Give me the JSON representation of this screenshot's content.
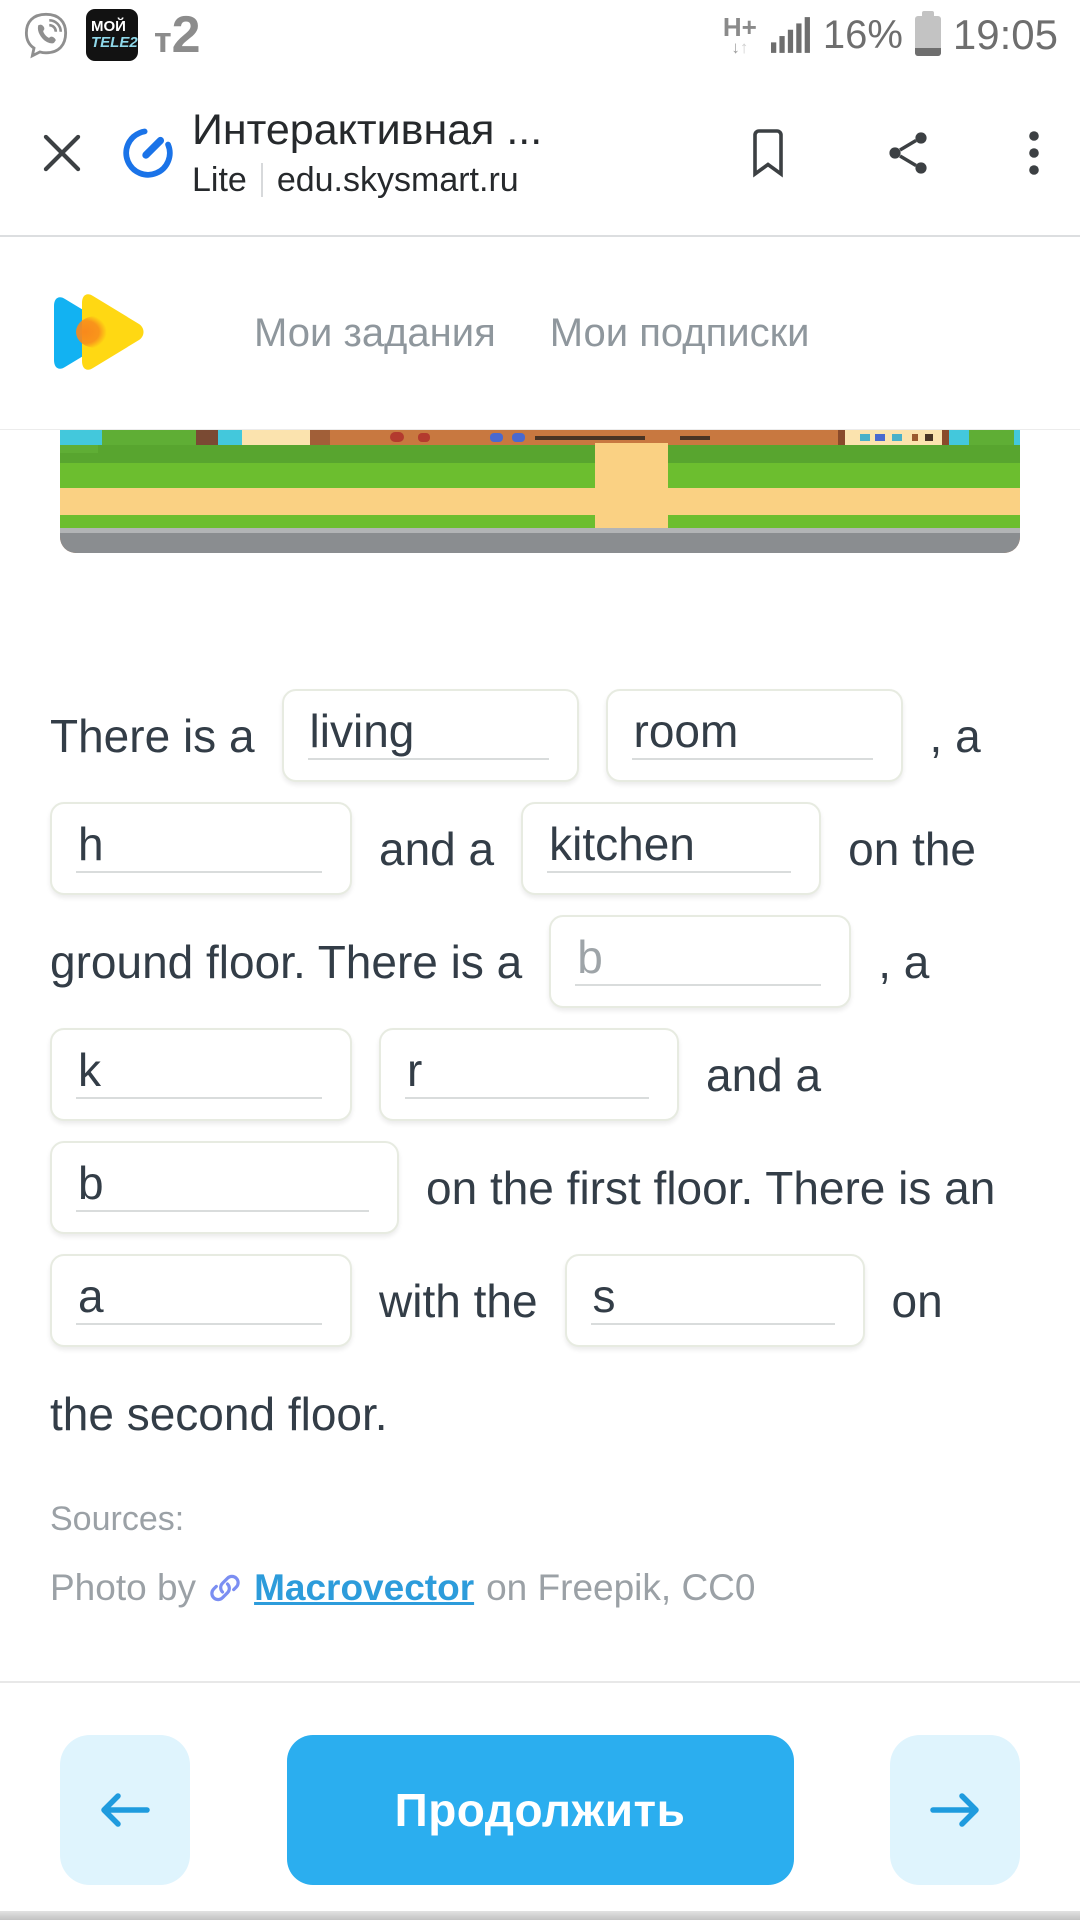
{
  "status_bar": {
    "time": "19:05",
    "battery_percent": "16%",
    "network_type": "H+",
    "carrier_badge_line1": "МОЙ",
    "carrier_badge_line2": "TELE2",
    "carrier_logo_t": "т",
    "carrier_logo_2": "2"
  },
  "browser": {
    "page_title": "Интерактивная ...",
    "mode_label": "Lite",
    "url": "edu.skysmart.ru"
  },
  "nav": {
    "links": [
      {
        "label": "Мои задания"
      },
      {
        "label": "Мои подписки"
      }
    ]
  },
  "exercise": {
    "rows": [
      {
        "segments": [
          {
            "type": "text",
            "text": "There is a"
          },
          {
            "type": "input",
            "value": "living",
            "state": "filled",
            "width": 297
          },
          {
            "type": "input",
            "value": "room",
            "state": "filled",
            "width": 297
          },
          {
            "type": "text",
            "text": ", a"
          }
        ]
      },
      {
        "segments": [
          {
            "type": "input",
            "value": "h",
            "state": "filled",
            "width": 302
          },
          {
            "type": "text",
            "text": "and a"
          },
          {
            "type": "input",
            "value": "kitchen",
            "state": "filled",
            "width": 300
          },
          {
            "type": "text",
            "text": "on the"
          }
        ]
      },
      {
        "segments": [
          {
            "type": "text",
            "text": "ground floor. There is a"
          },
          {
            "type": "input",
            "value": "b",
            "state": "hint",
            "width": 302
          },
          {
            "type": "text",
            "text": ", a"
          }
        ]
      },
      {
        "segments": [
          {
            "type": "input",
            "value": "k",
            "state": "filled",
            "width": 302
          },
          {
            "type": "input",
            "value": "r",
            "state": "filled",
            "width": 300
          },
          {
            "type": "text",
            "text": "and a"
          }
        ]
      },
      {
        "segments": [
          {
            "type": "input",
            "value": "b",
            "state": "filled",
            "width": 349
          },
          {
            "type": "text",
            "text": "on the first floor. There is an"
          }
        ]
      },
      {
        "segments": [
          {
            "type": "input",
            "value": "a",
            "state": "filled",
            "width": 302
          },
          {
            "type": "text",
            "text": "with the"
          },
          {
            "type": "input",
            "value": "s",
            "state": "filled",
            "width": 300
          },
          {
            "type": "text",
            "text": "on"
          }
        ]
      },
      {
        "segments": [
          {
            "type": "text",
            "text": "the second floor."
          }
        ]
      }
    ]
  },
  "sources": {
    "heading": "Sources:",
    "credit_prefix": "Photo by",
    "credit_link": "Macrovector",
    "credit_suffix": "on Freepik, CC0"
  },
  "footer": {
    "continue_label": "Продолжить"
  },
  "colors": {
    "accent_blue": "#2baeef",
    "light_blue": "#dff4fd",
    "arrow_blue": "#1f9bde",
    "link_blue": "#2d9cdb",
    "lite_icon_blue": "#1a73e8",
    "logo_blue": "#12b2f2",
    "logo_yellow": "#ffd813",
    "logo_orange": "#f8891c",
    "text_dark": "#333d47",
    "text_gray": "#9ba1a6"
  },
  "illustration": {
    "blocks": [
      {
        "x": 0,
        "y": 0,
        "w": 960,
        "h": 15,
        "c": "#c87840"
      },
      {
        "x": 0,
        "y": 15,
        "w": 960,
        "h": 18,
        "c": "#58a52f"
      },
      {
        "x": 0,
        "y": 33,
        "w": 960,
        "h": 25,
        "c": "#6cbe2f"
      },
      {
        "x": 0,
        "y": 58,
        "w": 960,
        "h": 27,
        "c": "#fad183"
      },
      {
        "x": 0,
        "y": 85,
        "w": 960,
        "h": 13,
        "c": "#6cbe2f"
      },
      {
        "x": 0,
        "y": 98,
        "w": 960,
        "h": 5,
        "c": "#b2b4b6"
      },
      {
        "x": 0,
        "y": 103,
        "w": 960,
        "h": 20,
        "c": "#8a8d90"
      },
      {
        "x": 535,
        "y": 13,
        "w": 73,
        "h": 85,
        "c": "#fad183"
      },
      {
        "x": 0,
        "y": 0,
        "w": 42,
        "h": 15,
        "c": "#43c8dc"
      },
      {
        "x": 42,
        "y": 0,
        "w": 94,
        "h": 15,
        "c": "#5fae35"
      },
      {
        "x": 0,
        "y": 15,
        "w": 38,
        "h": 8,
        "c": "#5fae35"
      },
      {
        "x": 136,
        "y": 0,
        "w": 22,
        "h": 15,
        "c": "#7a4a33"
      },
      {
        "x": 158,
        "y": 0,
        "w": 24,
        "h": 15,
        "c": "#43c8dc"
      },
      {
        "x": 182,
        "y": 0,
        "w": 68,
        "h": 15,
        "c": "#fbe3ae"
      },
      {
        "x": 250,
        "y": 0,
        "w": 20,
        "h": 15,
        "c": "#a15f38"
      },
      {
        "x": 330,
        "y": 2,
        "w": 14,
        "h": 10,
        "c": "#b33a2e",
        "r": 5
      },
      {
        "x": 358,
        "y": 3,
        "w": 12,
        "h": 9,
        "c": "#b33a2e",
        "r": 4
      },
      {
        "x": 430,
        "y": 3,
        "w": 13,
        "h": 9,
        "c": "#4a69cf",
        "r": 4
      },
      {
        "x": 452,
        "y": 3,
        "w": 13,
        "h": 9,
        "c": "#4a69cf",
        "r": 4
      },
      {
        "x": 475,
        "y": 6,
        "w": 110,
        "h": 4,
        "c": "#4a3424"
      },
      {
        "x": 620,
        "y": 6,
        "w": 30,
        "h": 4,
        "c": "#4a3424"
      },
      {
        "x": 778,
        "y": 0,
        "w": 7,
        "h": 15,
        "c": "#8a4a2a"
      },
      {
        "x": 785,
        "y": 0,
        "w": 97,
        "h": 15,
        "c": "#fbe3ae"
      },
      {
        "x": 800,
        "y": 4,
        "w": 10,
        "h": 7,
        "c": "#49b0c9"
      },
      {
        "x": 815,
        "y": 4,
        "w": 10,
        "h": 7,
        "c": "#4a69cf"
      },
      {
        "x": 832,
        "y": 4,
        "w": 10,
        "h": 7,
        "c": "#49b0c9"
      },
      {
        "x": 852,
        "y": 4,
        "w": 6,
        "h": 7,
        "c": "#9a5a30"
      },
      {
        "x": 865,
        "y": 4,
        "w": 8,
        "h": 7,
        "c": "#4a3424"
      },
      {
        "x": 882,
        "y": 0,
        "w": 7,
        "h": 15,
        "c": "#8a4a2a"
      },
      {
        "x": 889,
        "y": 0,
        "w": 20,
        "h": 15,
        "c": "#43c8dc"
      },
      {
        "x": 909,
        "y": 0,
        "w": 45,
        "h": 15,
        "c": "#5fae35"
      },
      {
        "x": 954,
        "y": 0,
        "w": 6,
        "h": 15,
        "c": "#43c8dc"
      }
    ]
  }
}
